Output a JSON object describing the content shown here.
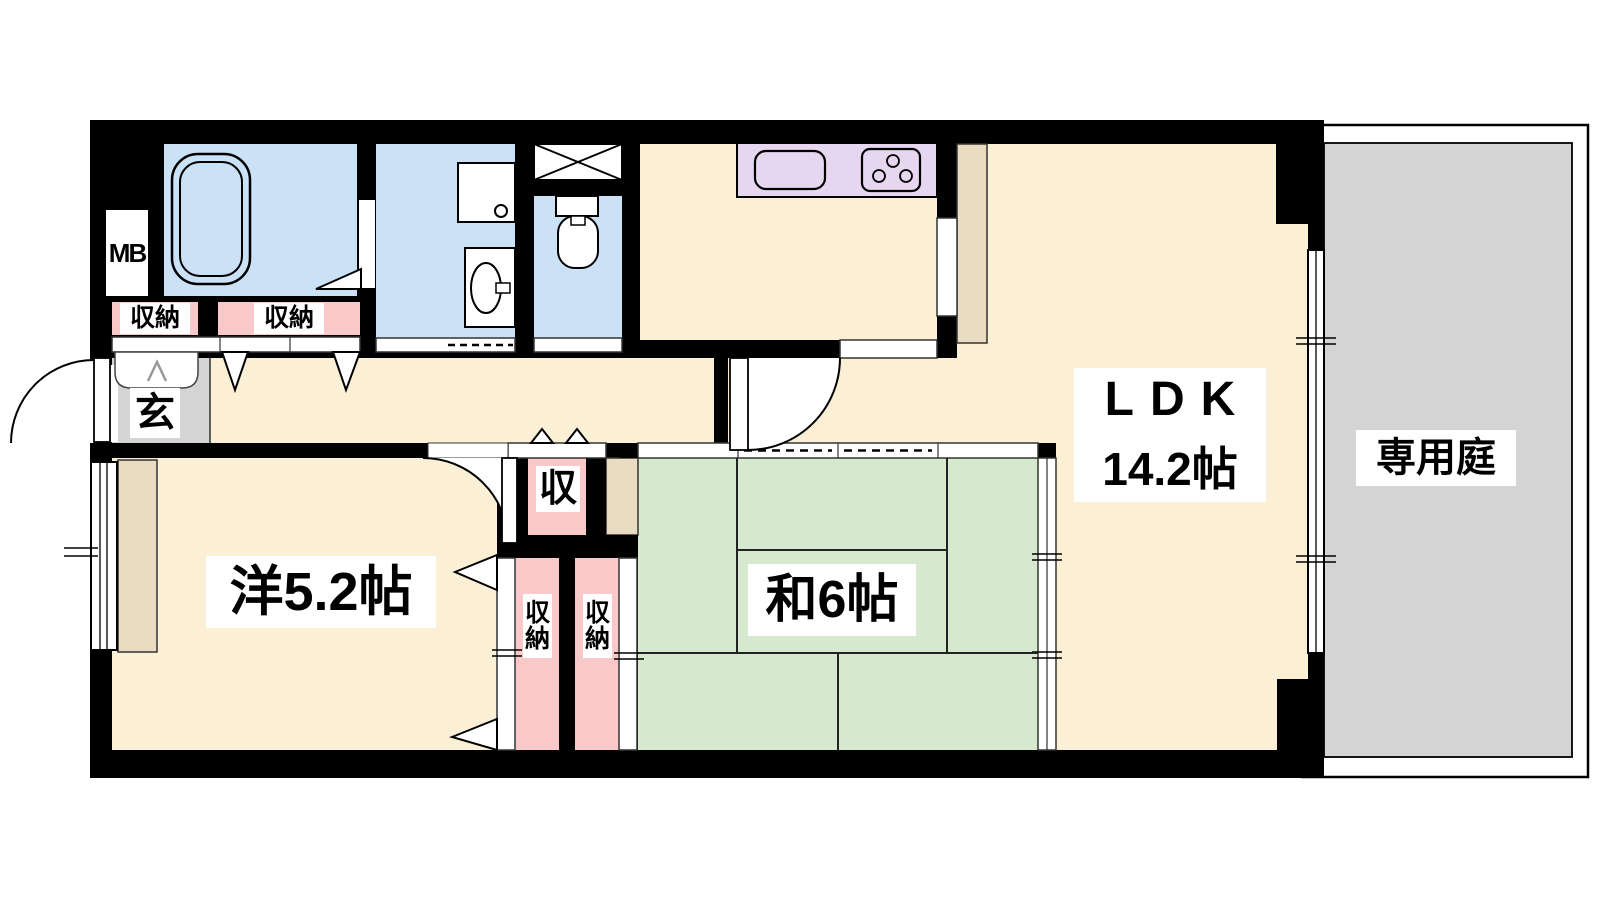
{
  "plan": {
    "title": "apartment-floor-plan",
    "rooms": {
      "ldk": {
        "label": "LDK",
        "size": "14.2帖"
      },
      "western_room": {
        "label": "洋5.2帖"
      },
      "japanese_room": {
        "label": "和6帖"
      },
      "private_garden": {
        "label": "専用庭"
      },
      "entrance": {
        "label": "玄"
      },
      "meter_box": {
        "label": "MB"
      }
    },
    "storage": {
      "entrance_closet_1": "収納",
      "entrance_closet_2": "収納",
      "western_small_closet": "収",
      "tall_closet_left": "収納",
      "tall_closet_right": "収納"
    },
    "colors": {
      "wall": "#000000",
      "room_cream": "#FBF0D5",
      "tatami_green": "#D6E8CD",
      "water_blue": "#CBE1F6",
      "closet_pink": "#F9C9C9",
      "kitchen_counter_lavender": "#E6D6EF",
      "entrance_grey": "#D4D4D4",
      "garden_grey": "#D4D4D4",
      "wood_tan": "#EADCC2"
    }
  }
}
